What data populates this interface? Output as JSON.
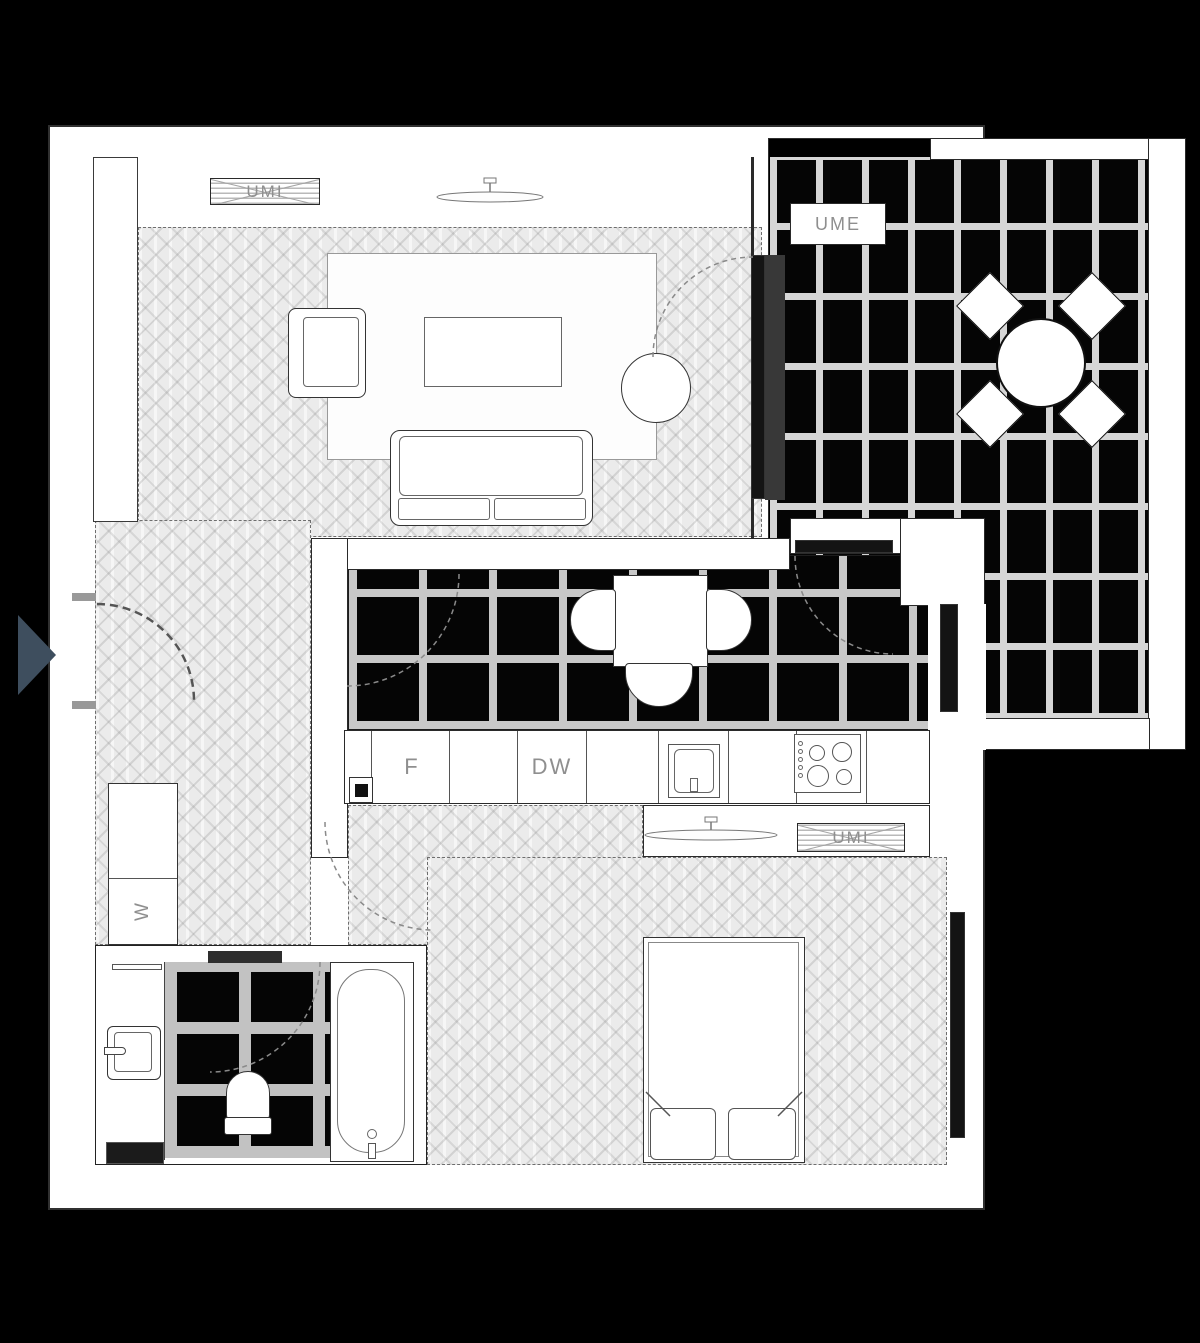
{
  "plan": {
    "units": {
      "ac_indoor_living": "UMI",
      "ac_outdoor_balcony": "UME",
      "ac_indoor_bedroom": "UMI"
    },
    "appliances": {
      "fridge": "F",
      "dishwasher": "DW",
      "washing_machine": "W"
    },
    "colors": {
      "background": "#000000",
      "wall": "#ffffff",
      "line": "#2a2a2a",
      "parquet": "#ebebeb",
      "dark_tile": "#050505",
      "grout": "#cccccc",
      "label_text": "#8f8f8f",
      "entry_marker": "#3e4e5e"
    }
  }
}
